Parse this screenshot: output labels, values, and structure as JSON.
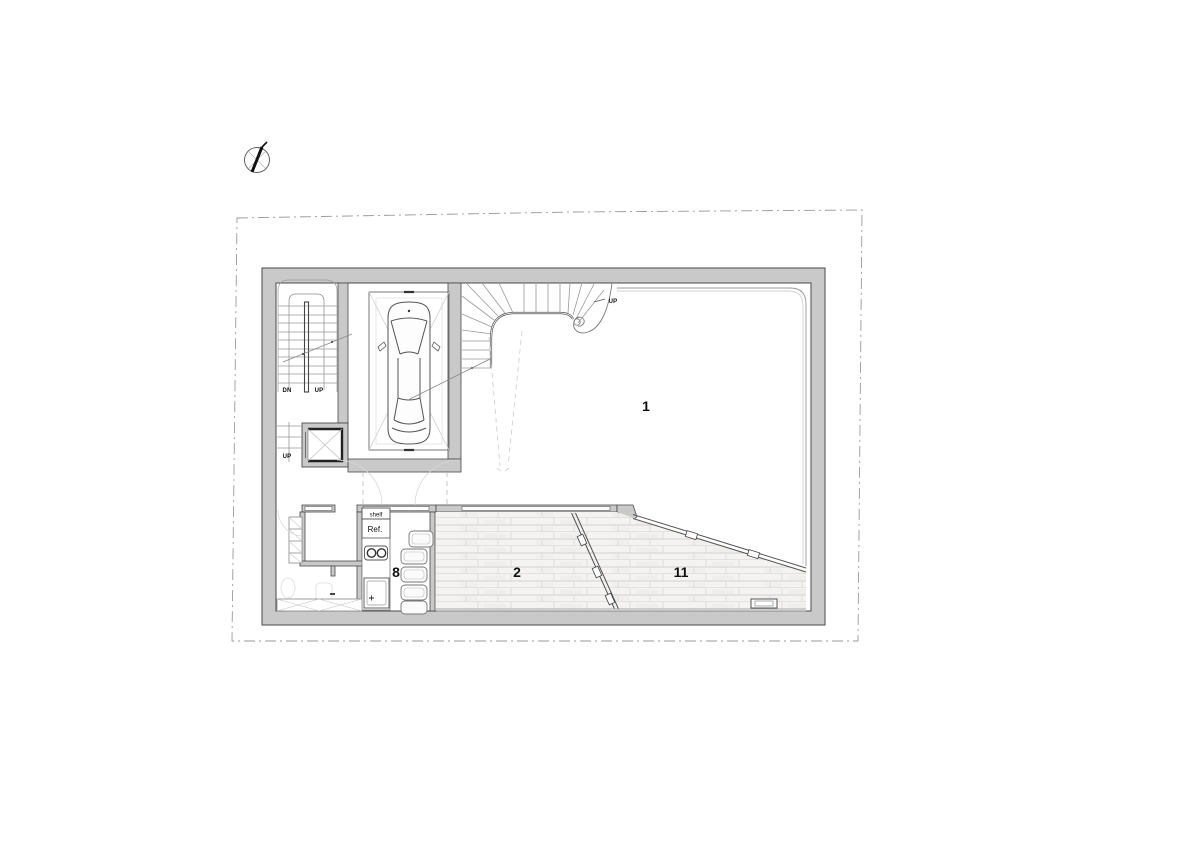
{
  "drawing": {
    "type": "architectural floor plan - basement / ground level",
    "labels": {
      "room1": "1",
      "room2": "2",
      "room8": "8",
      "room11": "11",
      "stair_dn": "DN",
      "stair_up": "UP",
      "stair_up_lower": "UP",
      "curved_stair_up": "UP",
      "shelf": "shelf",
      "refrigerator": "Ref."
    },
    "colors": {
      "background": "#ffffff",
      "wall_fill": "#c9c9c9",
      "wall_edge": "#4a4a4a",
      "line_dark": "#333333",
      "line_medium": "#8a8a8a",
      "line_light": "#c8c8c6",
      "floor_fill": "#f4f3f1",
      "boundary": "#9a9a9a",
      "text": "#111111"
    },
    "icons": {
      "north_arrow": "north-arrow-compass"
    }
  }
}
